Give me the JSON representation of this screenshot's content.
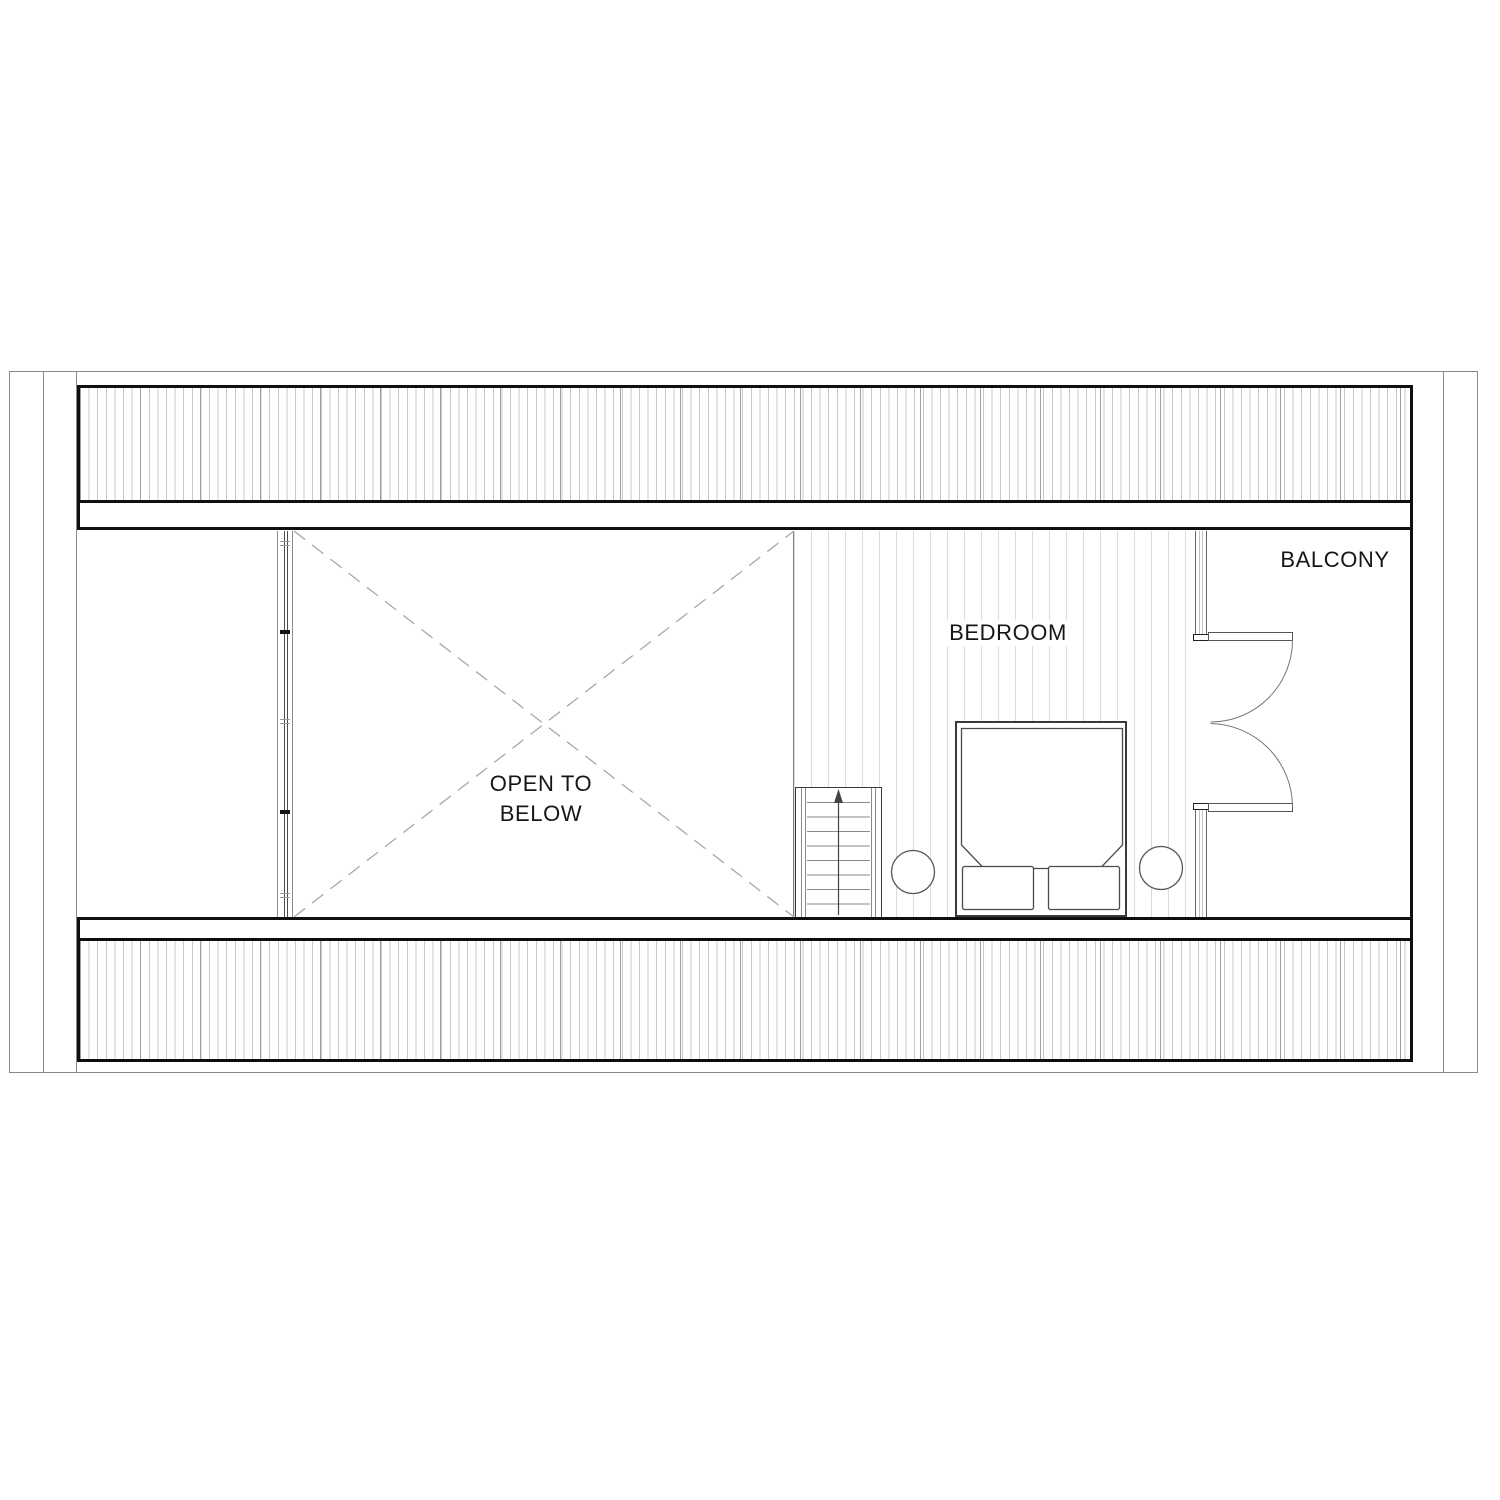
{
  "rooms": [
    {
      "id": "balcony",
      "label": "BALCONY"
    },
    {
      "id": "bedroom",
      "label": "BEDROOM"
    },
    {
      "id": "open-to-below",
      "label_line1": "OPEN TO",
      "label_line2": "BELOW"
    }
  ],
  "stairs": {
    "treads": 9,
    "direction": "up"
  },
  "colors": {
    "background": "#ffffff",
    "heavy_line": "#0f0f0f",
    "medium_line": "#4a4a4a",
    "light_line": "#8a8a8a",
    "band_hatch_line": "#c9c9c9",
    "floor_hatch_line": "#dcdcdc",
    "dashed_line": "#a8a8a8",
    "text": "#161616"
  }
}
